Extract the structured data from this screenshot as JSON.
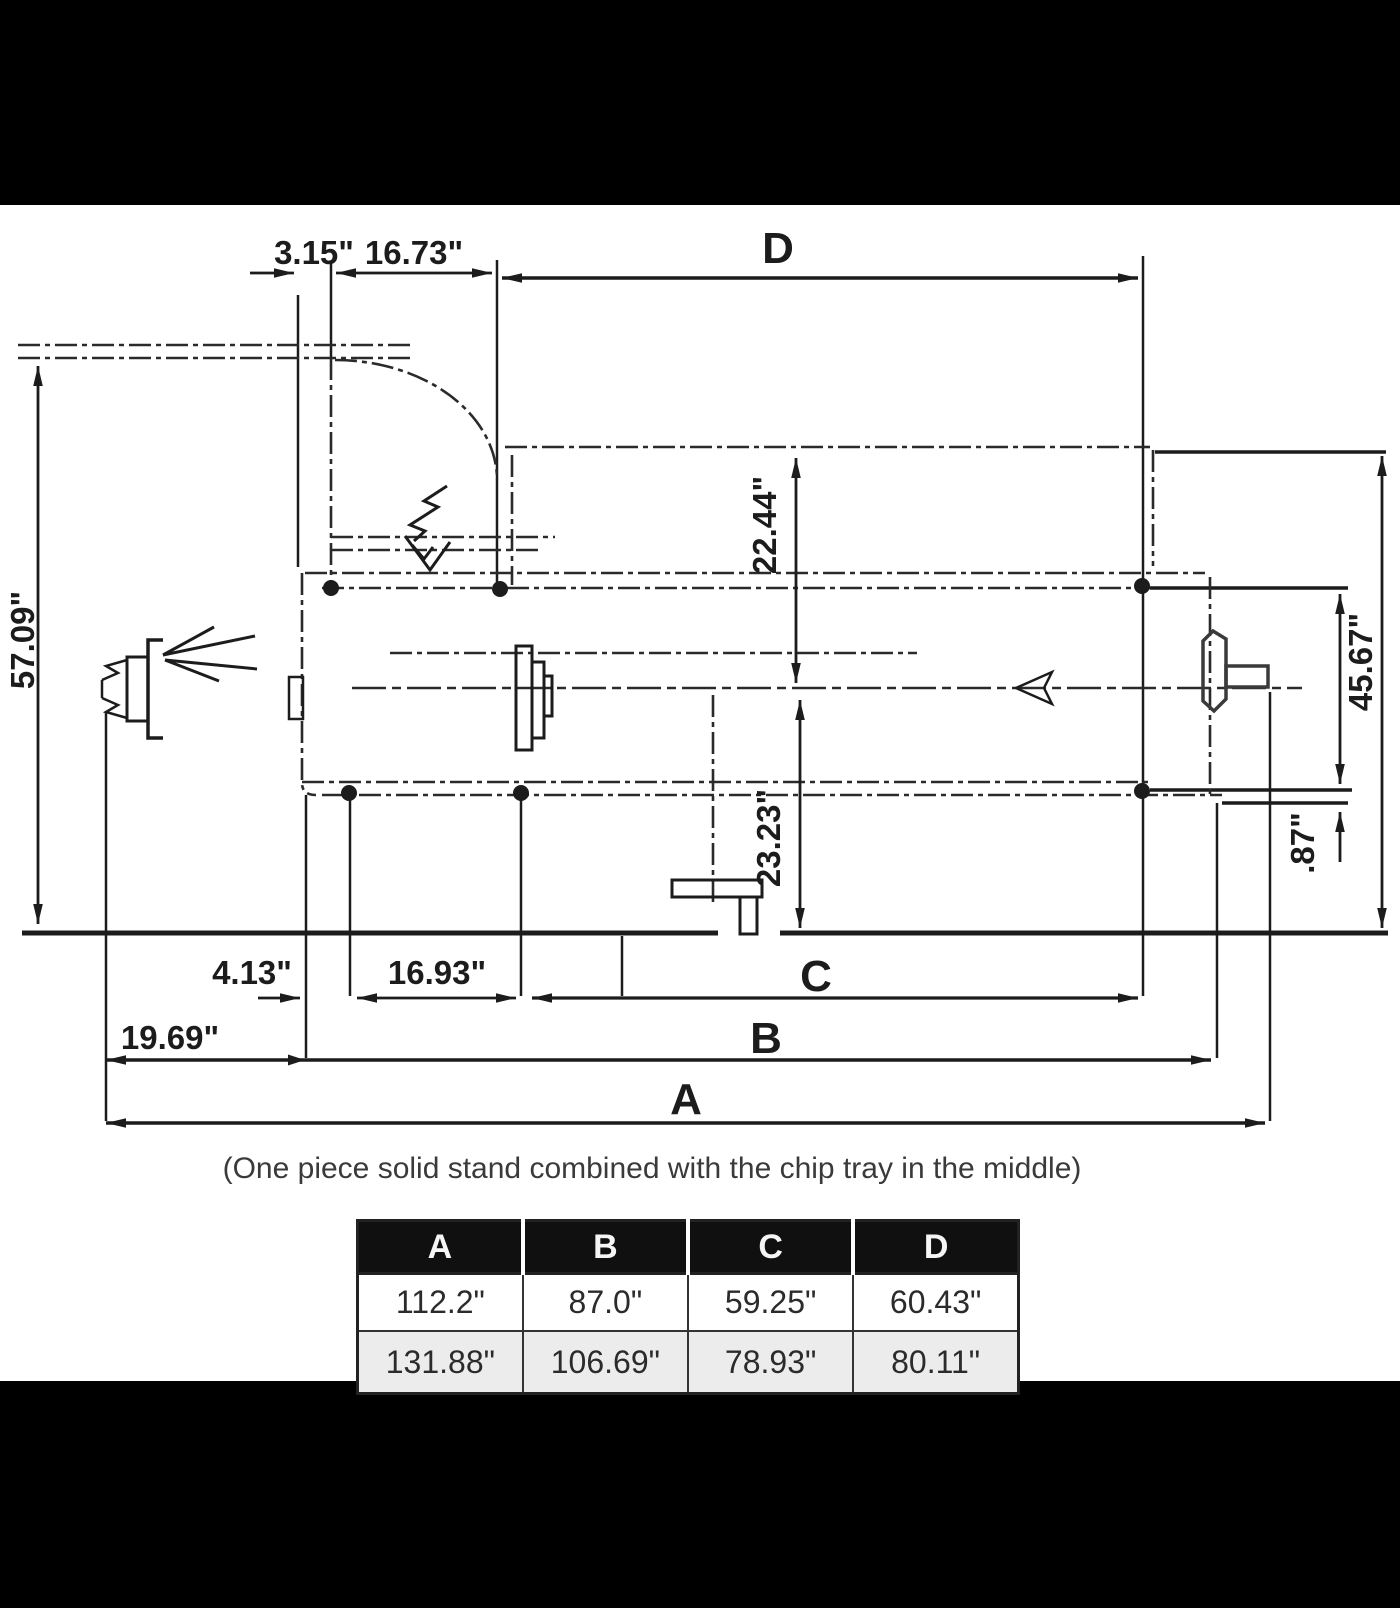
{
  "colors": {
    "ink": "#1c1c1c",
    "paper": "#ffffff",
    "letterbox": "#000000",
    "table_header_bg": "#101010",
    "table_alt_row_bg": "#ececec"
  },
  "drawing": {
    "dim_3_15": "3.15\"",
    "dim_16_73": "16.73\"",
    "dim_d": "D",
    "dim_57_09": "57.09\"",
    "dim_22_44": "22.44\"",
    "dim_23_23": "23.23\"",
    "dim_45_67": "45.67\"",
    "dim_0_87": ".87\"",
    "dim_4_13": "4.13\"",
    "dim_16_93": "16.93\"",
    "dim_19_69": "19.69\"",
    "dim_c": "C",
    "dim_b": "B",
    "dim_a": "A",
    "caption": "(One piece solid stand combined with the chip tray in the middle)"
  },
  "table": {
    "headers": [
      "A",
      "B",
      "C",
      "D"
    ],
    "rows": [
      [
        "112.2\"",
        "87.0\"",
        "59.25\"",
        "60.43\""
      ],
      [
        "131.88\"",
        "106.69\"",
        "78.93\"",
        "80.11\""
      ]
    ]
  }
}
